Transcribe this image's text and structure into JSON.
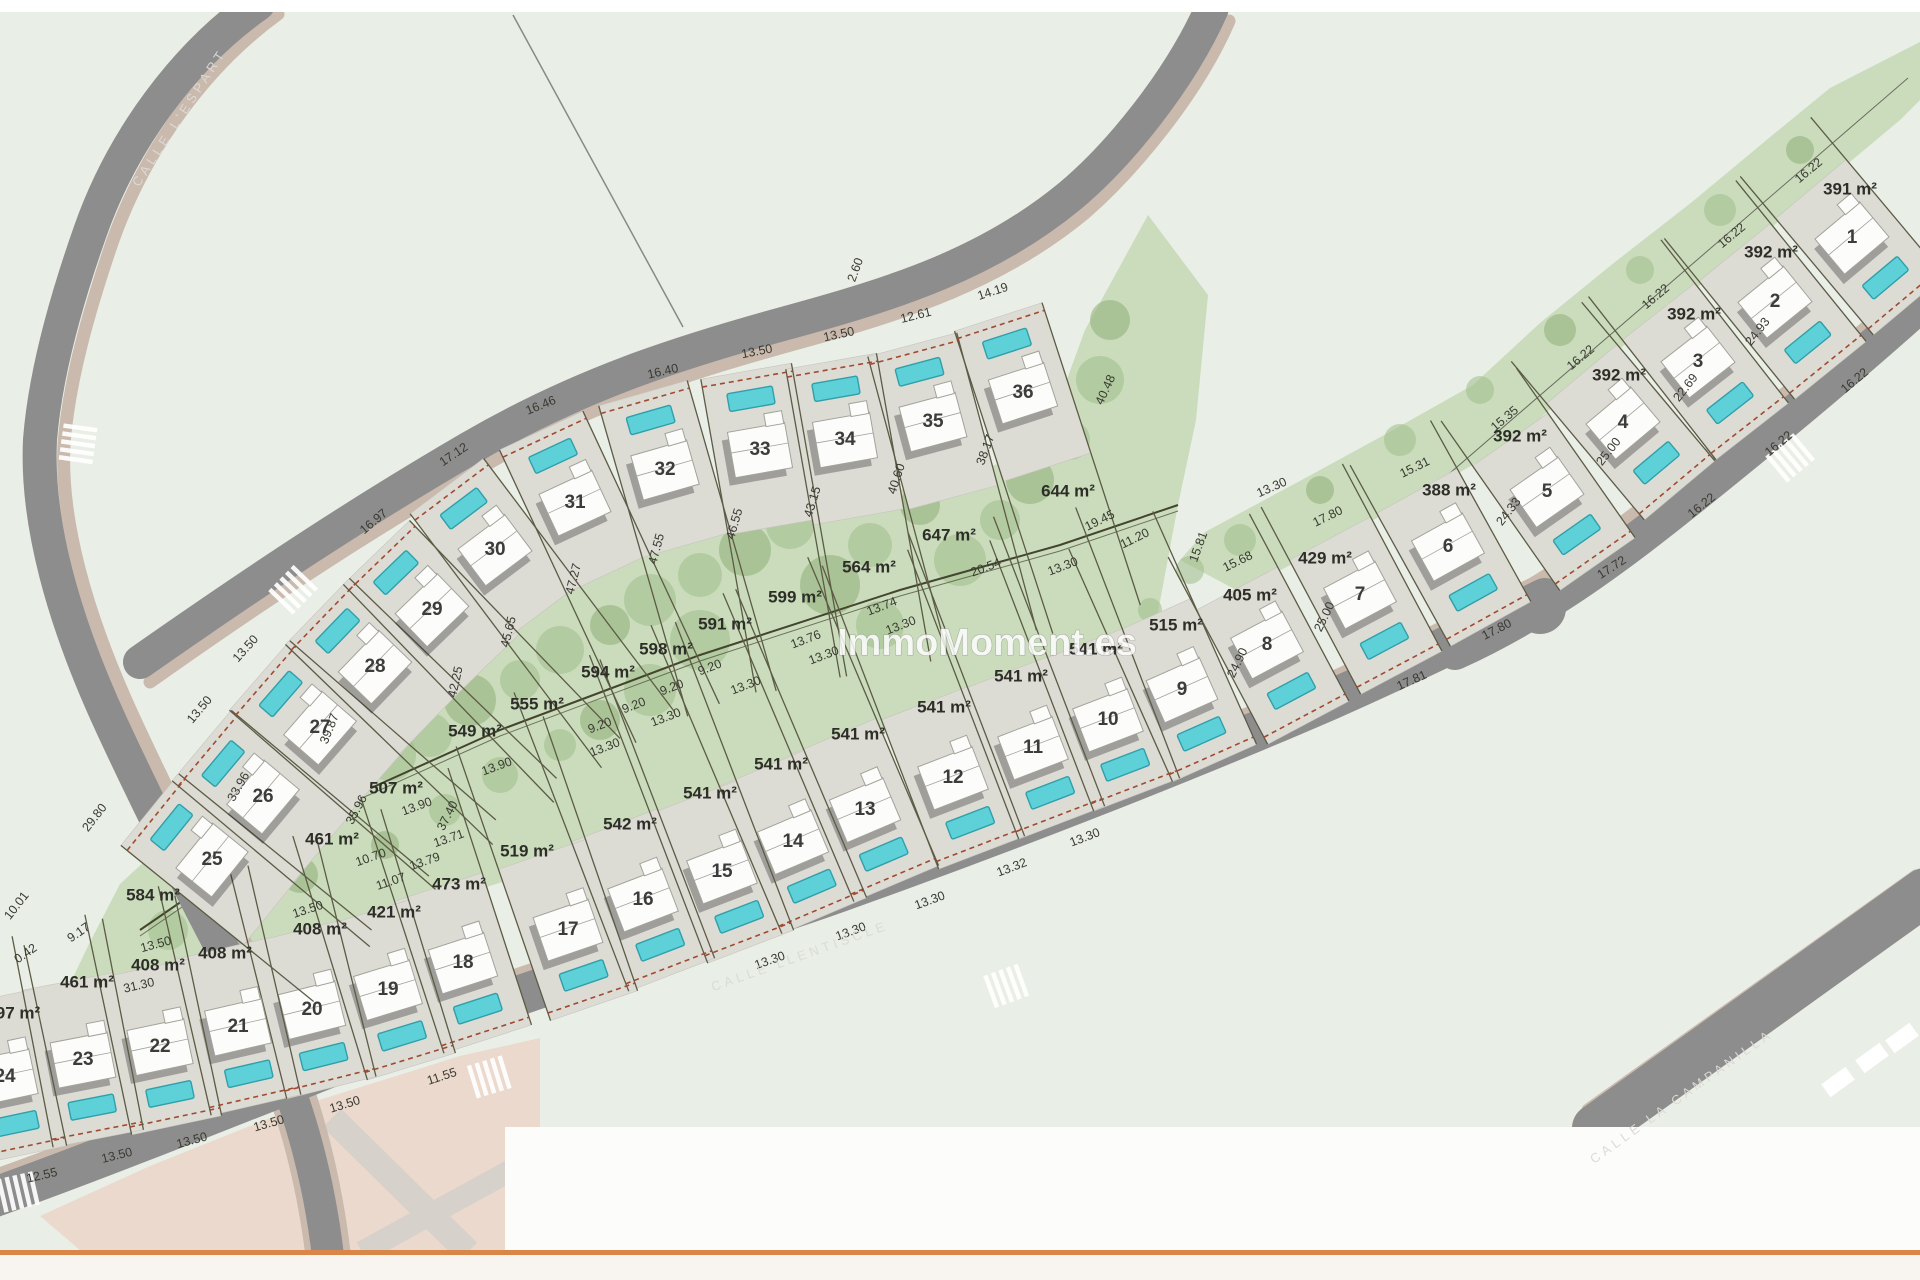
{
  "watermark": "ImmoMoment.es",
  "streets": [
    {
      "name": "CALLE  L'ESPART",
      "x": 180,
      "y": 118,
      "rot": -57
    },
    {
      "name": "CALLE LLENTISCLE",
      "x": 800,
      "y": 957,
      "rot": -19.5
    },
    {
      "name": "CALLE LA CAMPANILLA",
      "x": 1682,
      "y": 1097,
      "rot": -35.5
    }
  ],
  "plots": [
    {
      "number": "1",
      "area": "391 m²",
      "x": 1852,
      "y": 238,
      "rot": -40,
      "row": "right",
      "glen": 55
    },
    {
      "number": "2",
      "area": "392 m²",
      "x": 1775,
      "y": 302,
      "rot": -39,
      "row": "right",
      "glen": 55
    },
    {
      "number": "3",
      "area": "392 m²",
      "x": 1698,
      "y": 362,
      "rot": -38,
      "row": "right",
      "glen": 55
    },
    {
      "number": "4",
      "area": "392 m²",
      "x": 1623,
      "y": 423,
      "rot": -40,
      "row": "right",
      "glen": 55
    },
    {
      "number": "5",
      "area": "392 m²",
      "x": 1547,
      "y": 492,
      "rot": -35,
      "row": "right",
      "glen": 55
    },
    {
      "number": "6",
      "area": "388 m²",
      "x": 1448,
      "y": 547,
      "rot": -29,
      "row": "right",
      "glen": 55
    },
    {
      "number": "7",
      "area": "429 m²",
      "x": 1360,
      "y": 595,
      "rot": -28,
      "row": "right",
      "glen": 60
    },
    {
      "number": "8",
      "area": "405 m²",
      "x": 1267,
      "y": 645,
      "rot": -28,
      "row": "right",
      "glen": 60
    },
    {
      "number": "9",
      "area": "515 m²",
      "x": 1182,
      "y": 690,
      "rot": -24,
      "row": "lower",
      "glen": 95
    },
    {
      "number": "10",
      "area": "541 m²",
      "x": 1108,
      "y": 720,
      "rot": -21,
      "row": "lower",
      "glen": 130
    },
    {
      "number": "11",
      "area": "541 m²",
      "x": 1033,
      "y": 748,
      "rot": -21,
      "row": "lower",
      "glen": 150
    },
    {
      "number": "12",
      "area": "541 m²",
      "x": 953,
      "y": 778,
      "rot": -21,
      "row": "lower",
      "glen": 165
    },
    {
      "number": "13",
      "area": "541 m²",
      "x": 865,
      "y": 810,
      "rot": -23,
      "row": "lower",
      "glen": 175
    },
    {
      "number": "14",
      "area": "541 m²",
      "x": 793,
      "y": 842,
      "rot": -23,
      "row": "lower",
      "glen": 175
    },
    {
      "number": "15",
      "area": "541 m²",
      "x": 722,
      "y": 872,
      "rot": -21,
      "row": "lower",
      "glen": 170
    },
    {
      "number": "16",
      "area": "542 m²",
      "x": 643,
      "y": 900,
      "rot": -21,
      "row": "lower",
      "glen": 160
    },
    {
      "number": "17",
      "area": "519 m²",
      "x": 568,
      "y": 930,
      "rot": -19,
      "row": "lower",
      "glen": 130
    },
    {
      "number": "18",
      "area": "473 m²",
      "x": 463,
      "y": 963,
      "rot": -18,
      "row": "lower",
      "glen": 110
    },
    {
      "number": "19",
      "area": "421 m²",
      "x": 388,
      "y": 990,
      "rot": -17,
      "row": "lower",
      "glen": 95
    },
    {
      "number": "20",
      "area": "408 m²",
      "x": 312,
      "y": 1010,
      "rot": -14,
      "row": "lower",
      "glen": 85
    },
    {
      "number": "21",
      "area": "408 m²",
      "x": 238,
      "y": 1027,
      "rot": -13,
      "row": "lower",
      "glen": 75
    },
    {
      "number": "22",
      "area": "408 m²",
      "x": 160,
      "y": 1047,
      "rot": -12,
      "row": "lower",
      "glen": 65
    },
    {
      "number": "23",
      "area": "461 m²",
      "x": 83,
      "y": 1060,
      "rot": -11,
      "row": "lower",
      "glen": 55
    },
    {
      "number": "24",
      "area": "97 m²",
      "x": 5,
      "y": 1077,
      "rot": -12,
      "row": "lower",
      "glen": 45
    },
    {
      "number": "25",
      "area": "584 m²",
      "x": 212,
      "y": 860,
      "rot": -51,
      "row": "upper",
      "glen": 90
    },
    {
      "number": "26",
      "area": "461 m²",
      "x": 263,
      "y": 797,
      "rot": -50,
      "row": "upper",
      "glen": 100
    },
    {
      "number": "27",
      "area": "507 m²",
      "x": 320,
      "y": 728,
      "rot": -49,
      "row": "upper",
      "glen": 115
    },
    {
      "number": "28",
      "area": "549 m²",
      "x": 375,
      "y": 667,
      "rot": -46,
      "row": "upper",
      "glen": 130
    },
    {
      "number": "29",
      "area": "555 m²",
      "x": 432,
      "y": 610,
      "rot": -44,
      "row": "upper",
      "glen": 145
    },
    {
      "number": "30",
      "area": "594 m²",
      "x": 495,
      "y": 550,
      "rot": -37,
      "row": "upper",
      "glen": 160
    },
    {
      "number": "31",
      "area": "598 m²",
      "x": 575,
      "y": 503,
      "rot": -25,
      "row": "upper",
      "glen": 165
    },
    {
      "number": "32",
      "area": "591 m²",
      "x": 665,
      "y": 470,
      "rot": -16,
      "row": "upper",
      "glen": 165
    },
    {
      "number": "33",
      "area": "599 m²",
      "x": 760,
      "y": 450,
      "rot": -10,
      "row": "upper",
      "glen": 160
    },
    {
      "number": "34",
      "area": "564 m²",
      "x": 845,
      "y": 440,
      "rot": -10,
      "row": "upper",
      "glen": 155
    },
    {
      "number": "35",
      "area": "647 m²",
      "x": 933,
      "y": 422,
      "rot": -15,
      "row": "upper",
      "glen": 150
    },
    {
      "number": "36",
      "area": "644 m²",
      "x": 1023,
      "y": 393,
      "rot": -18,
      "row": "upper",
      "glen": 160
    }
  ],
  "area_labels": [
    {
      "t": "391 m²",
      "x": 1850,
      "y": 190
    },
    {
      "t": "392 m²",
      "x": 1771,
      "y": 253
    },
    {
      "t": "392 m²",
      "x": 1694,
      "y": 315
    },
    {
      "t": "392 m²",
      "x": 1619,
      "y": 376
    },
    {
      "t": "392 m²",
      "x": 1520,
      "y": 437
    },
    {
      "t": "388 m²",
      "x": 1449,
      "y": 491
    },
    {
      "t": "429 m²",
      "x": 1325,
      "y": 559
    },
    {
      "t": "405 m²",
      "x": 1250,
      "y": 596
    },
    {
      "t": "515 m²",
      "x": 1176,
      "y": 626
    },
    {
      "t": "541 m²",
      "x": 1096,
      "y": 650
    },
    {
      "t": "541 m²",
      "x": 1021,
      "y": 677
    },
    {
      "t": "541 m²",
      "x": 944,
      "y": 708
    },
    {
      "t": "541 m²",
      "x": 858,
      "y": 735
    },
    {
      "t": "541 m²",
      "x": 781,
      "y": 765
    },
    {
      "t": "541 m²",
      "x": 710,
      "y": 794
    },
    {
      "t": "542 m²",
      "x": 630,
      "y": 825
    },
    {
      "t": "519 m²",
      "x": 527,
      "y": 852
    },
    {
      "t": "473 m²",
      "x": 459,
      "y": 885
    },
    {
      "t": "421 m²",
      "x": 394,
      "y": 913
    },
    {
      "t": "408 m²",
      "x": 320,
      "y": 930
    },
    {
      "t": "408 m²",
      "x": 225,
      "y": 954
    },
    {
      "t": "408 m²",
      "x": 158,
      "y": 966
    },
    {
      "t": "461 m²",
      "x": 87,
      "y": 983
    },
    {
      "t": "97 m²",
      "x": 18,
      "y": 1014
    },
    {
      "t": "584 m²",
      "x": 153,
      "y": 896
    },
    {
      "t": "461 m²",
      "x": 332,
      "y": 840
    },
    {
      "t": "507 m²",
      "x": 396,
      "y": 789
    },
    {
      "t": "549 m²",
      "x": 475,
      "y": 732
    },
    {
      "t": "555 m²",
      "x": 537,
      "y": 705
    },
    {
      "t": "594 m²",
      "x": 608,
      "y": 673
    },
    {
      "t": "598 m²",
      "x": 666,
      "y": 650
    },
    {
      "t": "591 m²",
      "x": 725,
      "y": 625
    },
    {
      "t": "599 m²",
      "x": 795,
      "y": 598
    },
    {
      "t": "564 m²",
      "x": 869,
      "y": 568
    },
    {
      "t": "647 m²",
      "x": 949,
      "y": 536
    },
    {
      "t": "644 m²",
      "x": 1068,
      "y": 492
    }
  ],
  "dims": [
    {
      "t": "13.50",
      "x": 246,
      "y": 649,
      "r": -48
    },
    {
      "t": "16.97",
      "x": 374,
      "y": 522,
      "r": -40
    },
    {
      "t": "17.12",
      "x": 454,
      "y": 455,
      "r": -34
    },
    {
      "t": "16.46",
      "x": 541,
      "y": 406,
      "r": -22
    },
    {
      "t": "16.40",
      "x": 663,
      "y": 372,
      "r": -13
    },
    {
      "t": "13.50",
      "x": 757,
      "y": 352,
      "r": -11
    },
    {
      "t": "13.50",
      "x": 839,
      "y": 335,
      "r": -12
    },
    {
      "t": "12.61",
      "x": 916,
      "y": 316,
      "r": -14
    },
    {
      "t": "14.19",
      "x": 993,
      "y": 292,
      "r": -18
    },
    {
      "t": "2.60",
      "x": 856,
      "y": 270,
      "r": -70
    },
    {
      "t": "40.48",
      "x": 1106,
      "y": 390,
      "r": -65
    },
    {
      "t": "38.17",
      "x": 986,
      "y": 450,
      "r": -70
    },
    {
      "t": "40.60",
      "x": 897,
      "y": 479,
      "r": -72
    },
    {
      "t": "43.15",
      "x": 813,
      "y": 502,
      "r": -73
    },
    {
      "t": "46.55",
      "x": 735,
      "y": 524,
      "r": -74
    },
    {
      "t": "47.55",
      "x": 657,
      "y": 549,
      "r": -75
    },
    {
      "t": "47.27",
      "x": 574,
      "y": 579,
      "r": -76
    },
    {
      "t": "45.65",
      "x": 509,
      "y": 632,
      "r": -76
    },
    {
      "t": "42.25",
      "x": 456,
      "y": 682,
      "r": -77
    },
    {
      "t": "39.87",
      "x": 330,
      "y": 729,
      "r": -68
    },
    {
      "t": "33.96",
      "x": 239,
      "y": 787,
      "r": -60
    },
    {
      "t": "35.96",
      "x": 357,
      "y": 810,
      "r": -62
    },
    {
      "t": "37.40",
      "x": 448,
      "y": 816,
      "r": -63
    },
    {
      "t": "13.90",
      "x": 497,
      "y": 767,
      "r": -20
    },
    {
      "t": "13.90",
      "x": 417,
      "y": 807,
      "r": -20
    },
    {
      "t": "13.71",
      "x": 449,
      "y": 839,
      "r": -19
    },
    {
      "t": "13.79",
      "x": 425,
      "y": 862,
      "r": -19
    },
    {
      "t": "10.70",
      "x": 371,
      "y": 858,
      "r": -19
    },
    {
      "t": "11.07",
      "x": 391,
      "y": 882,
      "r": -19
    },
    {
      "t": "13.50",
      "x": 308,
      "y": 910,
      "r": -18
    },
    {
      "t": "13.50",
      "x": 156,
      "y": 945,
      "r": -15
    },
    {
      "t": "31.30",
      "x": 139,
      "y": 986,
      "r": -13
    },
    {
      "t": "29.80",
      "x": 95,
      "y": 818,
      "r": -52
    },
    {
      "t": "10.01",
      "x": 17,
      "y": 906,
      "r": -52
    },
    {
      "t": "9.17",
      "x": 79,
      "y": 933,
      "r": -35
    },
    {
      "t": "0.42",
      "x": 26,
      "y": 954,
      "r": -35
    },
    {
      "t": "13.50",
      "x": 200,
      "y": 710,
      "r": -50
    },
    {
      "t": "9.20",
      "x": 600,
      "y": 726,
      "r": -21
    },
    {
      "t": "9.20",
      "x": 634,
      "y": 706,
      "r": -21
    },
    {
      "t": "9.20",
      "x": 672,
      "y": 688,
      "r": -21
    },
    {
      "t": "9.20",
      "x": 710,
      "y": 668,
      "r": -21
    },
    {
      "t": "13.30",
      "x": 605,
      "y": 748,
      "r": -21
    },
    {
      "t": "13.30",
      "x": 666,
      "y": 718,
      "r": -21
    },
    {
      "t": "13.30",
      "x": 746,
      "y": 686,
      "r": -21
    },
    {
      "t": "13.30",
      "x": 824,
      "y": 656,
      "r": -21
    },
    {
      "t": "13.30",
      "x": 901,
      "y": 626,
      "r": -21
    },
    {
      "t": "13.76",
      "x": 806,
      "y": 640,
      "r": -21
    },
    {
      "t": "13.74",
      "x": 882,
      "y": 607,
      "r": -21
    },
    {
      "t": "20.54",
      "x": 986,
      "y": 568,
      "r": -21
    },
    {
      "t": "13.30",
      "x": 1063,
      "y": 567,
      "r": -21
    },
    {
      "t": "13.30",
      "x": 1272,
      "y": 488,
      "r": -24
    },
    {
      "t": "19.45",
      "x": 1100,
      "y": 521,
      "r": -26
    },
    {
      "t": "11.20",
      "x": 1135,
      "y": 539,
      "r": -26
    },
    {
      "t": "15.81",
      "x": 1199,
      "y": 547,
      "r": -70
    },
    {
      "t": "15.68",
      "x": 1238,
      "y": 562,
      "r": -26
    },
    {
      "t": "17.80",
      "x": 1328,
      "y": 517,
      "r": -26
    },
    {
      "t": "12.55",
      "x": 42,
      "y": 1176,
      "r": -13
    },
    {
      "t": "13.50",
      "x": 117,
      "y": 1156,
      "r": -14
    },
    {
      "t": "13.50",
      "x": 192,
      "y": 1141,
      "r": -15
    },
    {
      "t": "13.50",
      "x": 269,
      "y": 1124,
      "r": -16
    },
    {
      "t": "13.50",
      "x": 345,
      "y": 1105,
      "r": -17
    },
    {
      "t": "11.55",
      "x": 442,
      "y": 1077,
      "r": -18
    },
    {
      "t": "13.30",
      "x": 770,
      "y": 961,
      "r": -19
    },
    {
      "t": "13.30",
      "x": 851,
      "y": 932,
      "r": -20
    },
    {
      "t": "13.30",
      "x": 930,
      "y": 901,
      "r": -20
    },
    {
      "t": "13.32",
      "x": 1012,
      "y": 868,
      "r": -21
    },
    {
      "t": "13.30",
      "x": 1085,
      "y": 838,
      "r": -21
    },
    {
      "t": "17.81",
      "x": 1412,
      "y": 681,
      "r": -24
    },
    {
      "t": "17.80",
      "x": 1497,
      "y": 630,
      "r": -27
    },
    {
      "t": "17.72",
      "x": 1612,
      "y": 568,
      "r": -33
    },
    {
      "t": "16.22",
      "x": 1702,
      "y": 506,
      "r": -39
    },
    {
      "t": "16.22",
      "x": 1779,
      "y": 444,
      "r": -40
    },
    {
      "t": "16.22",
      "x": 1855,
      "y": 381,
      "r": -40
    },
    {
      "t": "16.22",
      "x": 1809,
      "y": 171,
      "r": -40
    },
    {
      "t": "16.22",
      "x": 1732,
      "y": 236,
      "r": -40
    },
    {
      "t": "16.22",
      "x": 1656,
      "y": 297,
      "r": -40
    },
    {
      "t": "16.22",
      "x": 1581,
      "y": 358,
      "r": -40
    },
    {
      "t": "15.35",
      "x": 1505,
      "y": 419,
      "r": -40
    },
    {
      "t": "15.31",
      "x": 1415,
      "y": 468,
      "r": -26
    },
    {
      "t": "24.93",
      "x": 1758,
      "y": 332,
      "r": -52
    },
    {
      "t": "22.69",
      "x": 1686,
      "y": 388,
      "r": -52
    },
    {
      "t": "25.00",
      "x": 1609,
      "y": 452,
      "r": -52
    },
    {
      "t": "24.33",
      "x": 1509,
      "y": 512,
      "r": -52
    },
    {
      "t": "25.00",
      "x": 1325,
      "y": 617,
      "r": -64
    },
    {
      "t": "24.90",
      "x": 1238,
      "y": 663,
      "r": -64
    }
  ],
  "colors": {
    "background": "#e9eee6",
    "green": "#cadcbc",
    "tree": "#9fbd8a",
    "tree2": "#8fae77",
    "pad": "#dcdbd4",
    "pad_stroke": "#c6c5be",
    "road": "#8d8d8d",
    "sidewalk": "#cab9ad",
    "pavement": "#ead9cc",
    "pavement_road": "#d6d1cb",
    "pool": "#5ed1d8",
    "pool_stroke": "#2f9faa",
    "house": "#fcfcfb",
    "house_stroke": "#a3a39c",
    "shadow": "rgba(30,30,30,0.32)",
    "parcel_line": "#5c5b45",
    "frontage": "#a04a30",
    "spine": "#45442f",
    "white_band": "#fcfcfb",
    "orange_line": "#d98648",
    "bottom_strip": "#f8f5f1",
    "crosswalk": "#ffffff"
  }
}
